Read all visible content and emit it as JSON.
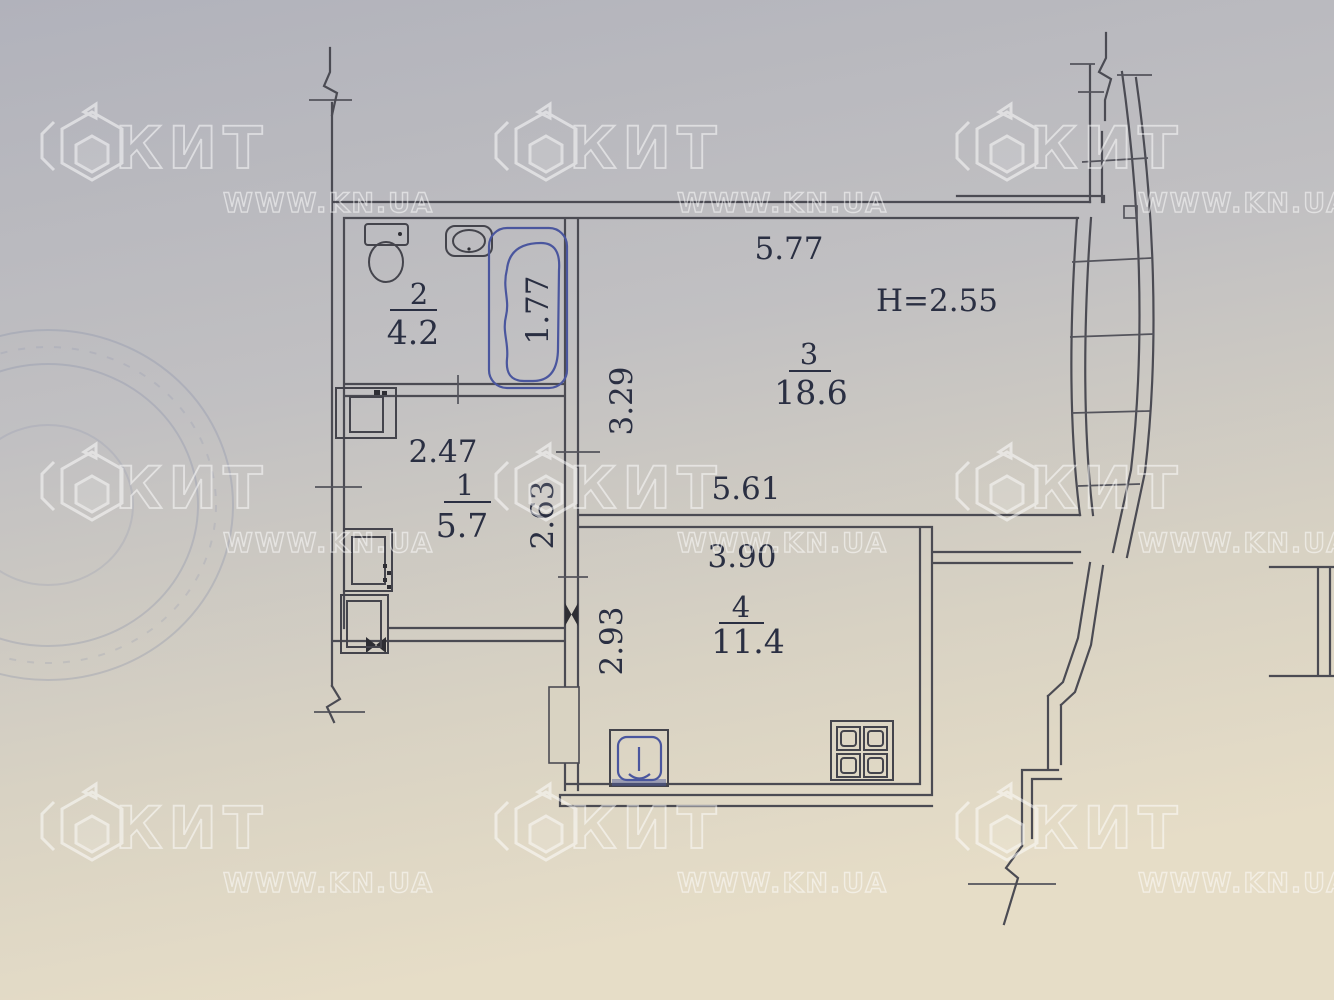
{
  "watermark": {
    "brand": "КИТ",
    "site": "WWW.KN.UA"
  },
  "plan": {
    "ceiling_height": "H=2.55",
    "rooms": {
      "bathroom": {
        "number": "2",
        "area": "4.2"
      },
      "hall": {
        "number": "1",
        "area": "5.7"
      },
      "living": {
        "number": "3",
        "area": "18.6"
      },
      "kitchen": {
        "number": "4",
        "area": "11.4"
      }
    },
    "dims": {
      "living_top": "5.77",
      "living_left": "3.29",
      "living_bottom": "5.61",
      "bathtub": "1.77",
      "hall_top": "2.47",
      "hall_left": "2.63",
      "kitchen_top": "3.90",
      "kitchen_left": "2.93"
    }
  }
}
